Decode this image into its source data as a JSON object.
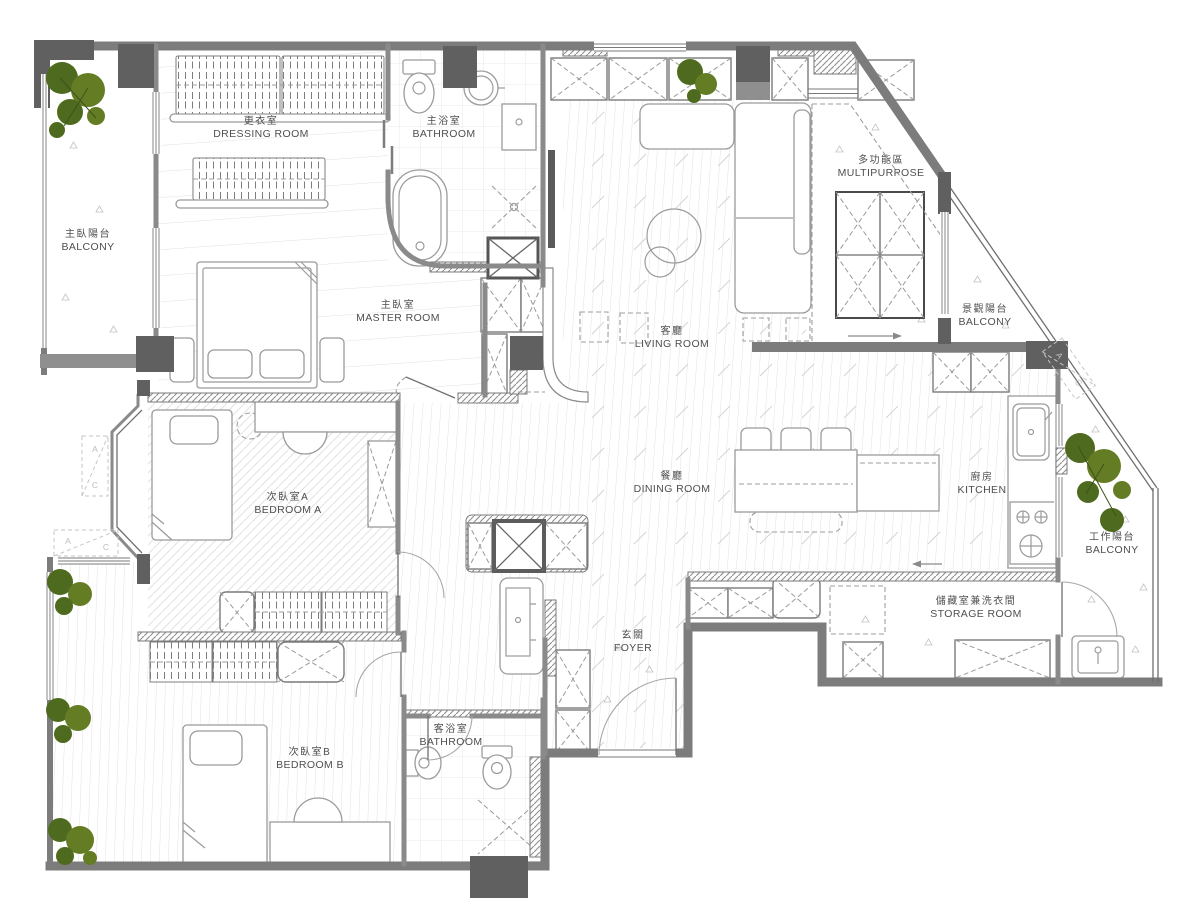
{
  "plan": {
    "name": "residential-floor-plan",
    "colors": {
      "wall": "#7c7c7c",
      "column": "#606060",
      "furniture_line": "#9b9b9b",
      "label_text": "#4f4f4f",
      "plant_green": "#4e6a1e",
      "floor_line": "#dcdcdc"
    },
    "rooms": [
      {
        "id": "dressing-room",
        "zh": "更衣室",
        "en": "DRESSING ROOM",
        "cx": 261,
        "cy": 121
      },
      {
        "id": "master-bathroom",
        "zh": "主浴室",
        "en": "BATHROOM",
        "cx": 444,
        "cy": 121
      },
      {
        "id": "master-balcony",
        "zh": "主臥陽台",
        "en": "BALCONY",
        "cx": 88,
        "cy": 234
      },
      {
        "id": "master-room",
        "zh": "主臥室",
        "en": "MASTER ROOM",
        "cx": 398,
        "cy": 305
      },
      {
        "id": "multipurpose",
        "zh": "多功能區",
        "en": "MULTIPURPOSE",
        "cx": 881,
        "cy": 160
      },
      {
        "id": "living-room",
        "zh": "客廳",
        "en": "LIVING ROOM",
        "cx": 672,
        "cy": 331
      },
      {
        "id": "view-balcony",
        "zh": "景觀陽台",
        "en": "BALCONY",
        "cx": 985,
        "cy": 309
      },
      {
        "id": "bedroom-a",
        "zh": "次臥室A",
        "en": "BEDROOM A",
        "cx": 288,
        "cy": 497
      },
      {
        "id": "dining-room",
        "zh": "餐廳",
        "en": "DINING ROOM",
        "cx": 672,
        "cy": 476
      },
      {
        "id": "kitchen",
        "zh": "廚房",
        "en": "KITCHEN",
        "cx": 982,
        "cy": 477
      },
      {
        "id": "work-balcony",
        "zh": "工作陽台",
        "en": "BALCONY",
        "cx": 1112,
        "cy": 537
      },
      {
        "id": "storage-room",
        "zh": "儲藏室兼洗衣間",
        "en": "STORAGE ROOM",
        "cx": 976,
        "cy": 601
      },
      {
        "id": "foyer",
        "zh": "玄關",
        "en": "FOYER",
        "cx": 633,
        "cy": 635
      },
      {
        "id": "bedroom-b",
        "zh": "次臥室B",
        "en": "BEDROOM B",
        "cx": 310,
        "cy": 752
      },
      {
        "id": "guest-bathroom",
        "zh": "客浴室",
        "en": "BATHROOM",
        "cx": 451,
        "cy": 729
      }
    ],
    "ac_marker": {
      "a": "A",
      "c": "C"
    }
  }
}
